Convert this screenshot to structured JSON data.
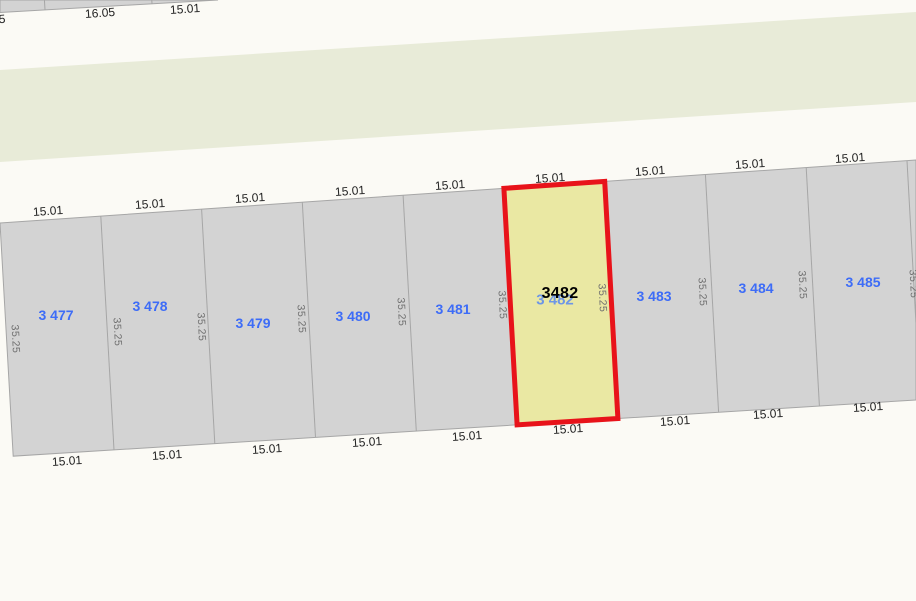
{
  "colors": {
    "background_color": "#fbfaf5",
    "parcel_fill": "#d3d3d3",
    "parcel_line": "#a6a6a6",
    "road_fill": "#e8ebd8",
    "selected_fill": "#eae8a3",
    "selected_stroke": "#e8131a",
    "lot_label_color": "#3d6cf7",
    "selected_label_color": "#000000",
    "shadow_label_color": "#6d96e6",
    "frontage_label_color": "#222222",
    "depth_label_color": "#6e6e6e"
  },
  "geometry": {
    "width": 916,
    "height": 601,
    "band": {
      "top_left_y": 223,
      "top_right_y": 160,
      "bottom_left_y": 457,
      "bottom_right_y": 400
    },
    "boundaries_top_x": [
      0,
      100.8,
      201.6,
      302.3,
      403.1,
      503.9,
      604.7,
      705.4,
      806.2,
      907
    ],
    "lean_dx": 13.2,
    "selected_cell": 5,
    "road_points": [
      [
        0,
        70
      ],
      [
        916,
        12
      ],
      [
        916,
        102
      ],
      [
        0,
        162
      ]
    ],
    "upper_block_outline": [
      [
        0,
        0
      ],
      [
        218,
        0
      ],
      [
        0,
        12.5
      ]
    ],
    "upper_block_lines": [
      [
        [
          44.4,
          0
        ],
        [
          45,
          9.6
        ]
      ],
      [
        [
          151.8,
          0
        ],
        [
          152,
          3.6
        ]
      ]
    ]
  },
  "parcels": [
    {
      "lot": "3 477",
      "x": 56,
      "y": 315
    },
    {
      "lot": "3 478",
      "x": 150,
      "y": 306
    },
    {
      "lot": "3 479",
      "x": 253,
      "y": 323
    },
    {
      "lot": "3 480",
      "x": 353,
      "y": 316
    },
    {
      "lot": "3 481",
      "x": 453,
      "y": 309
    },
    {
      "lot": "3 483",
      "x": 654,
      "y": 296
    },
    {
      "lot": "3 484",
      "x": 756,
      "y": 288
    },
    {
      "lot": "3 485",
      "x": 863,
      "y": 282
    }
  ],
  "selected": {
    "label": "3482",
    "x": 560,
    "y": 294,
    "shadow_label": "3 482",
    "shadow_x": 555,
    "shadow_y": 300
  },
  "frontage_top": [
    {
      "text": "15.01",
      "x": 48,
      "y": 211
    },
    {
      "text": "15.01",
      "x": 150,
      "y": 204
    },
    {
      "text": "15.01",
      "x": 250,
      "y": 198
    },
    {
      "text": "15.01",
      "x": 350,
      "y": 191
    },
    {
      "text": "15.01",
      "x": 450,
      "y": 185
    },
    {
      "text": "15.01",
      "x": 550,
      "y": 178
    },
    {
      "text": "15.01",
      "x": 650,
      "y": 171
    },
    {
      "text": "15.01",
      "x": 750,
      "y": 164
    },
    {
      "text": "15.01",
      "x": 850,
      "y": 158
    }
  ],
  "frontage_bottom": [
    {
      "text": "15.01",
      "x": 67,
      "y": 461
    },
    {
      "text": "15.01",
      "x": 167,
      "y": 455
    },
    {
      "text": "15.01",
      "x": 267,
      "y": 449
    },
    {
      "text": "15.01",
      "x": 367,
      "y": 442
    },
    {
      "text": "15.01",
      "x": 467,
      "y": 436
    },
    {
      "text": "15.01",
      "x": 568,
      "y": 429
    },
    {
      "text": "15.01",
      "x": 675,
      "y": 421
    },
    {
      "text": "15.01",
      "x": 768,
      "y": 414
    },
    {
      "text": "15.01",
      "x": 868,
      "y": 407
    }
  ],
  "depth_labels": [
    {
      "text": "35.25",
      "x": 15,
      "y": 339
    },
    {
      "text": "35.25",
      "x": 117,
      "y": 332
    },
    {
      "text": "35.25",
      "x": 201,
      "y": 327
    },
    {
      "text": "35.25",
      "x": 301,
      "y": 319
    },
    {
      "text": "35.25",
      "x": 401,
      "y": 312
    },
    {
      "text": "35.25",
      "x": 502,
      "y": 305
    },
    {
      "text": "35.25",
      "x": 602,
      "y": 298
    },
    {
      "text": "35.25",
      "x": 702,
      "y": 292
    },
    {
      "text": "35.25",
      "x": 802,
      "y": 285
    },
    {
      "text": "35.25",
      "x": 913,
      "y": 284
    }
  ],
  "upper_block_labels": [
    {
      "text": "5",
      "x": 2,
      "y": 19
    },
    {
      "text": "16.05",
      "x": 100,
      "y": 13
    },
    {
      "text": "15.01",
      "x": 185,
      "y": 9
    }
  ]
}
